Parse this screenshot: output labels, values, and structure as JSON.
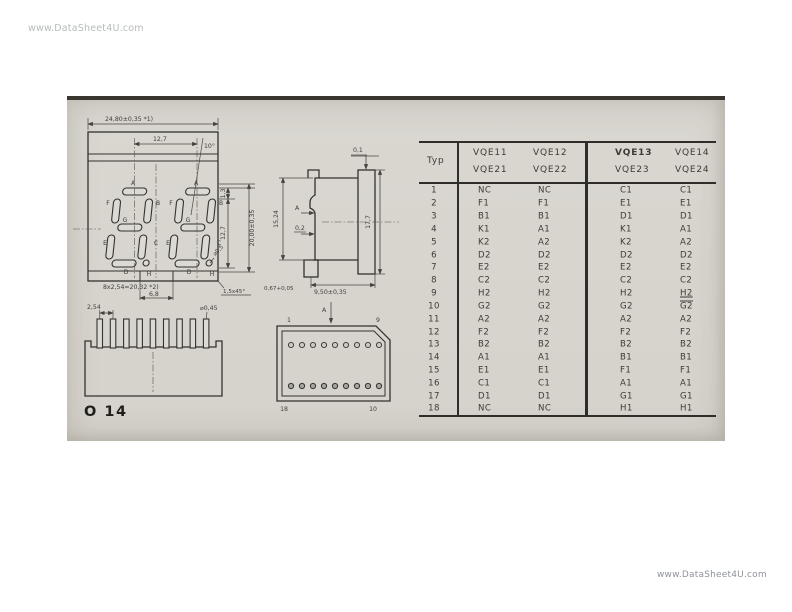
{
  "watermarks": {
    "top": "www.DataSheet4U.com",
    "bottom": "www.DataSheet4U.com"
  },
  "page_label": "O 14",
  "colors": {
    "panel_bg": "#d7d4ce",
    "ink": "#34322e",
    "rule": "#2f2d29"
  },
  "front_view": {
    "dim_overall_width": "24,80±0,35 *1)",
    "dim_digit_pitch": "12,7",
    "dim_tilt": "10°",
    "dim_seg_width": "1,3",
    "dim_digit_height": "12,7",
    "dim_overall_height": "20,00±0,35",
    "dim_dp": "⌀0,5",
    "dim_notch": "6,8",
    "dim_chamfer": "1,5x45°",
    "dim_pin_pitch_row": "8x2,54=20,32 *2)",
    "segments": {
      "a": "A",
      "b": "B",
      "c": "C",
      "d": "D",
      "e": "E",
      "f": "F",
      "g": "G",
      "h": "H"
    }
  },
  "side_view": {
    "dim_top": "0,1",
    "section_label": "A",
    "dim_step": "0,2",
    "dim_height": "15,24",
    "dim_front_height": "17,7",
    "dim_pin_len": "0,67+0,05",
    "dim_depth": "9,50±0,35"
  },
  "pin_view": {
    "dim_pitch": "2,54",
    "dim_pin_dia": "⌀0,45"
  },
  "bottom_view": {
    "pin_tl": "1",
    "pin_tr": "9",
    "pin_bl": "18",
    "pin_br": "10",
    "section_label": "A"
  },
  "table": {
    "typ_header": "Typ",
    "groups": [
      {
        "top": "VQE11",
        "bottom": "VQE21"
      },
      {
        "top": "VQE12",
        "bottom": "VQE22"
      },
      {
        "top": "VQE13",
        "bottom": "VQE23"
      },
      {
        "top": "VQE14",
        "bottom": "VQE24"
      }
    ],
    "rows": [
      {
        "typ": "1",
        "cells": [
          "NC",
          "NC",
          "C1",
          "C1"
        ]
      },
      {
        "typ": "2",
        "cells": [
          "F1",
          "F1",
          "E1",
          "E1"
        ]
      },
      {
        "typ": "3",
        "cells": [
          "B1",
          "B1",
          "D1",
          "D1"
        ]
      },
      {
        "typ": "4",
        "cells": [
          "K1",
          "A1",
          "K1",
          "A1"
        ]
      },
      {
        "typ": "5",
        "cells": [
          "K2",
          "A2",
          "K2",
          "A2"
        ]
      },
      {
        "typ": "6",
        "cells": [
          "D2",
          "D2",
          "D2",
          "D2"
        ]
      },
      {
        "typ": "7",
        "cells": [
          "E2",
          "E2",
          "E2",
          "E2"
        ]
      },
      {
        "typ": "8",
        "cells": [
          "C2",
          "C2",
          "C2",
          "C2"
        ]
      },
      {
        "typ": "9",
        "cells": [
          "H2",
          "H2",
          "H2",
          "H2"
        ],
        "deco": {
          "3": "underline"
        }
      },
      {
        "typ": "10",
        "cells": [
          "G2",
          "G2",
          "G2",
          "G2"
        ],
        "deco": {
          "3": "overline"
        }
      },
      {
        "typ": "11",
        "cells": [
          "A2",
          "A2",
          "A2",
          "A2"
        ]
      },
      {
        "typ": "12",
        "cells": [
          "F2",
          "F2",
          "F2",
          "F2"
        ]
      },
      {
        "typ": "13",
        "cells": [
          "B2",
          "B2",
          "B2",
          "B2"
        ]
      },
      {
        "typ": "14",
        "cells": [
          "A1",
          "A1",
          "B1",
          "B1"
        ]
      },
      {
        "typ": "15",
        "cells": [
          "E1",
          "E1",
          "F1",
          "F1"
        ]
      },
      {
        "typ": "16",
        "cells": [
          "C1",
          "C1",
          "A1",
          "A1"
        ]
      },
      {
        "typ": "17",
        "cells": [
          "D1",
          "D1",
          "G1",
          "G1"
        ]
      },
      {
        "typ": "18",
        "cells": [
          "NC",
          "NC",
          "H1",
          "H1"
        ]
      }
    ]
  }
}
